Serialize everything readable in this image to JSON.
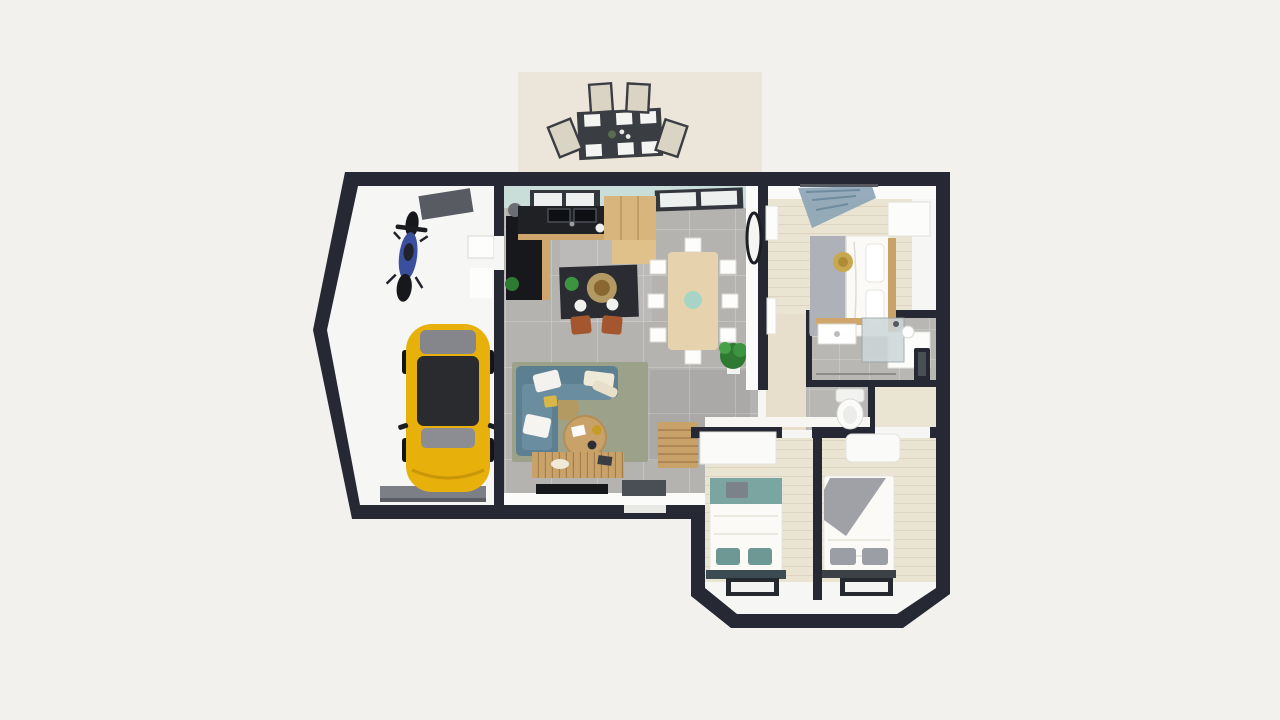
{
  "scene": {
    "type": "floor-plan-3d-render",
    "view": "top-down",
    "description": "3D rendered house floor plan with garage, open kitchen-living room, three bedrooms, bathroom, WC and rear terrace"
  },
  "palette": {
    "background": "#f2f1ee",
    "wall": "#262933",
    "wall_face": "#fbfbf9",
    "floor_white": "#f6f6f4",
    "tile_grey": "#b5b3b0",
    "tile_bath": "#b9b7b4",
    "plank_beige": "#eae4d3",
    "hall_wood": "#e7dfcc",
    "terrace": "#ece6da",
    "seafoam_wall": "#c9ded8",
    "counter_black": "#1f2125",
    "island_black": "#2a2c31",
    "wood_light": "#d8b57c",
    "wood_mid": "#c9a26a",
    "wood_trim": "#cfa66c",
    "car_yellow": "#e8b00a",
    "car_glass": "#2a2b2e",
    "moto_blue": "#3a4f9e",
    "sofa_blue": "#5d7f92",
    "sofa_seat": "#6b8da0",
    "rug_olive": "#9aa086",
    "jute": "#b29a62",
    "bed_grey": "#aeb2b8",
    "bed_teal": "#7aa5a1",
    "blanket_grey": "#9fa1a6",
    "curtain_blue": "#8ba3b5",
    "mat_dark": "#4a4e55",
    "garage_mat": "#585c62",
    "garage_door": "#7c8086",
    "stool_orange": "#a4572e",
    "plant_green": "#2f7a33",
    "plant_green2": "#3c9440",
    "vase_teal": "#a7d4c5",
    "white_furniture": "#fcfcfa",
    "glass_shower": "#cdd6d8",
    "dark_fixture": "#17181b"
  },
  "rooms": [
    {
      "name": "terrace",
      "furniture": [
        "outdoor-dining-table",
        "outdoor-chairs"
      ]
    },
    {
      "name": "garage",
      "furniture": [
        "motorcycle",
        "yellow-car",
        "ceiling-mat",
        "garage-door-strip"
      ]
    },
    {
      "name": "kitchen-living-room",
      "furniture": [
        "l-shaped-counter",
        "sink",
        "wood-cabinets",
        "kitchen-island",
        "bar-stools",
        "dining-table",
        "dining-chairs",
        "potted-plant",
        "sectional-sofa",
        "area-rug",
        "coffee-table",
        "tv-console",
        "tv",
        "door-mat",
        "wall-clock",
        "slat-bench"
      ]
    },
    {
      "name": "bedroom-master",
      "furniture": [
        "double-bed",
        "wardrobe",
        "curtain",
        "round-cushion"
      ]
    },
    {
      "name": "bathroom",
      "furniture": [
        "sink-vanity",
        "shower",
        "radiator",
        "pendant-lamp"
      ]
    },
    {
      "name": "wc",
      "furniture": [
        "toilet"
      ]
    },
    {
      "name": "hallway",
      "furniture": []
    },
    {
      "name": "bedroom-2",
      "furniture": [
        "double-bed-teal",
        "wardrobe",
        "window"
      ]
    },
    {
      "name": "bedroom-3",
      "furniture": [
        "double-bed-grey",
        "wardrobe",
        "window"
      ]
    }
  ]
}
